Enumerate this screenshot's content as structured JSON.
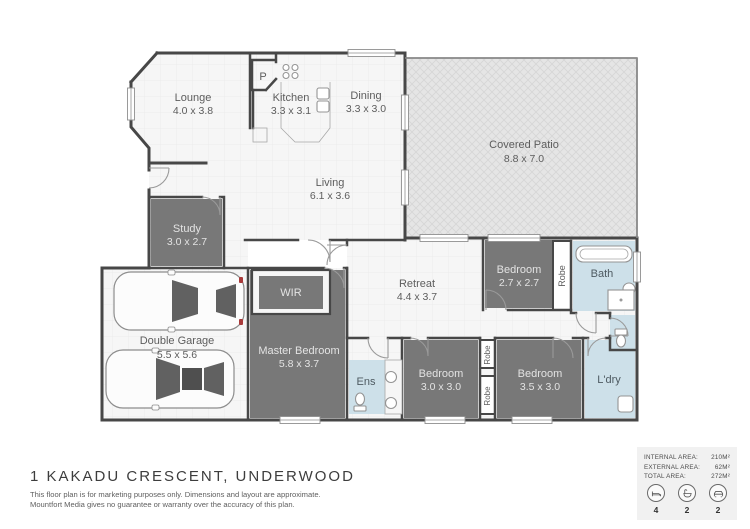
{
  "title": "1 KAKADU CRESCENT, UNDERWOOD",
  "disclaimer": {
    "line1": "This floor plan is for marketing purposes only. Dimensions and layout are approximate.",
    "line2": "Mountfort Media gives no guarantee or warranty over the accuracy of this plan."
  },
  "colors": {
    "dark_room": "#787878",
    "wet_room": "#cde0e9",
    "patio": "#e5e5e5",
    "wall": "#474747",
    "floor": "#f6f6f6"
  },
  "rooms": {
    "lounge": {
      "name": "Lounge",
      "dims": "4.0 x 3.8"
    },
    "kitchen": {
      "name": "Kitchen",
      "dims": "3.3 x 3.1"
    },
    "dining": {
      "name": "Dining",
      "dims": "3.3 x 3.0"
    },
    "patio": {
      "name": "Covered Patio",
      "dims": "8.8 x 7.0"
    },
    "living": {
      "name": "Living",
      "dims": "6.1 x 3.6"
    },
    "study": {
      "name": "Study",
      "dims": "3.0 x 2.7"
    },
    "garage": {
      "name": "Double Garage",
      "dims": "5.5 x 5.6"
    },
    "wir": {
      "name": "WIR"
    },
    "master": {
      "name": "Master Bedroom",
      "dims": "5.8 x 3.7"
    },
    "retreat": {
      "name": "Retreat",
      "dims": "4.4 x 3.7"
    },
    "bedroom2": {
      "name": "Bedroom",
      "dims": "2.7 x 2.7"
    },
    "bath": {
      "name": "Bath"
    },
    "ens": {
      "name": "Ens"
    },
    "bedroom3": {
      "name": "Bedroom",
      "dims": "3.0 x 3.0"
    },
    "bedroom4": {
      "name": "Bedroom",
      "dims": "3.5 x 3.0"
    },
    "laundry": {
      "name": "L'dry"
    },
    "pantry": {
      "name": "P"
    },
    "robe": {
      "name": "Robe"
    }
  },
  "summary": {
    "rows": [
      {
        "label": "INTERNAL AREA:",
        "value": "210M²"
      },
      {
        "label": "EXTERNAL AREA:",
        "value": "62M²"
      },
      {
        "label": "TOTAL AREA:",
        "value": "272M²"
      }
    ],
    "icons": [
      {
        "icon": "bed-icon",
        "count": "4"
      },
      {
        "icon": "bath-icon",
        "count": "2"
      },
      {
        "icon": "car-icon",
        "count": "2"
      }
    ]
  }
}
